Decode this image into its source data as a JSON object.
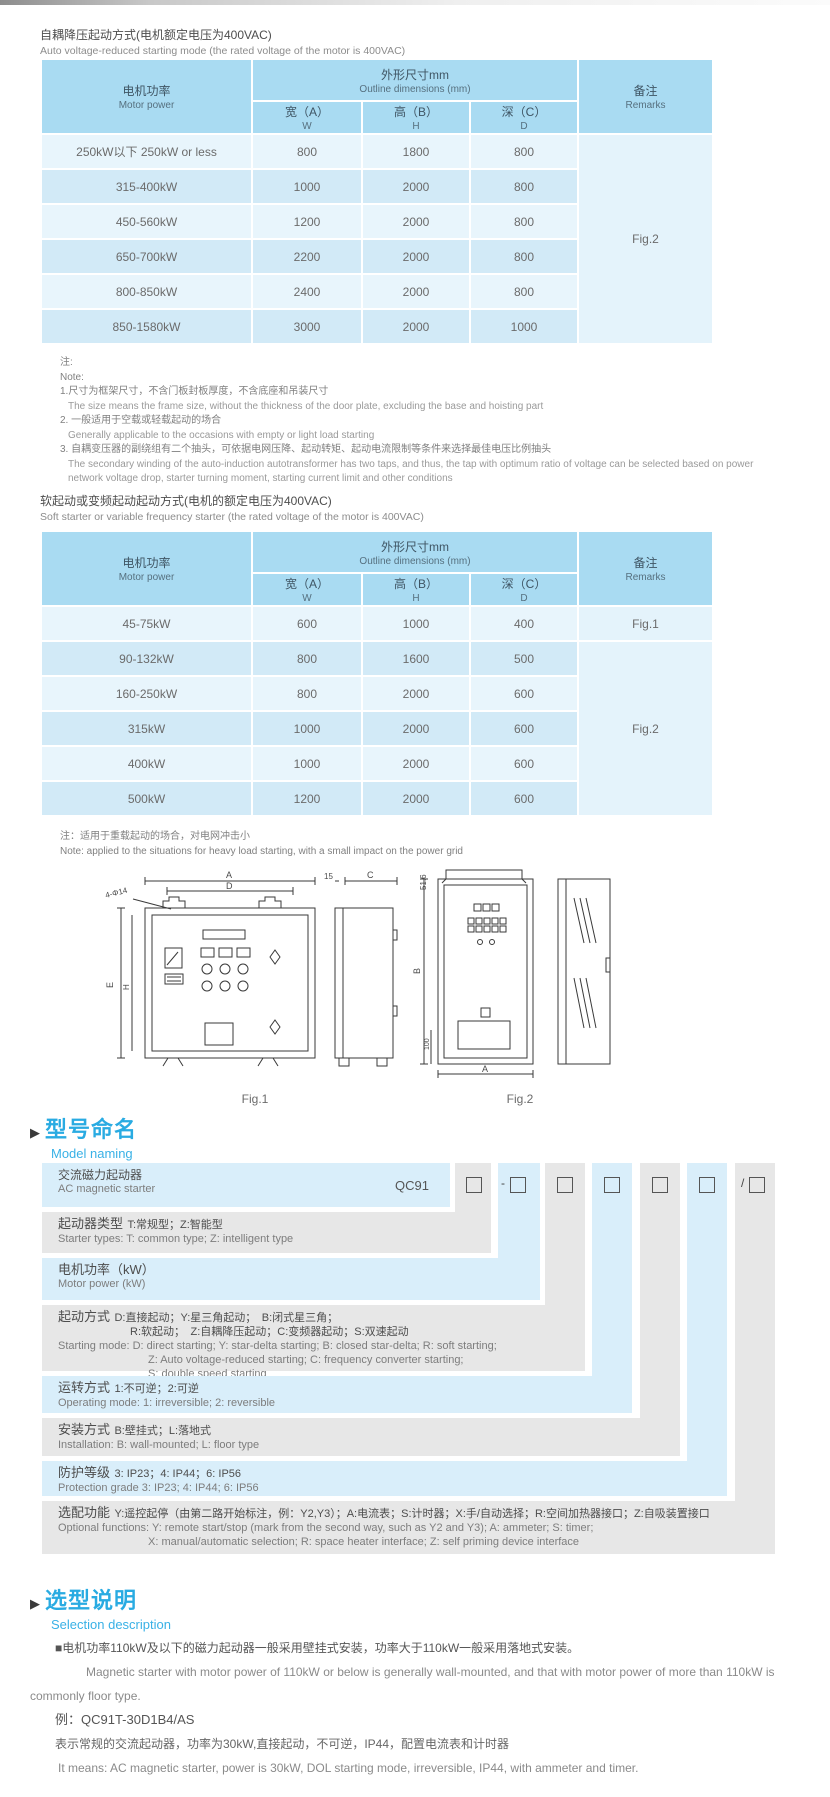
{
  "section1": {
    "title_cn": "自耦降压起动方式(电机额定电压为400VAC)",
    "title_en": "Auto voltage-reduced starting mode (the rated voltage of the motor is 400VAC)"
  },
  "dim_table_headers": {
    "motor_cn": "电机功率",
    "motor_en": "Motor power",
    "outline_cn": "外形尺寸mm",
    "outline_en": "Outline dimensions (mm)",
    "w_cn": "宽（A）",
    "w_en": "W",
    "h_cn": "高（B）",
    "h_en": "H",
    "d_cn": "深（C）",
    "d_en": "D",
    "remarks_cn": "备注",
    "remarks_en": "Remarks"
  },
  "table1": {
    "rows": [
      {
        "power": "250kW以下 250kW or less",
        "w": "800",
        "h": "1800",
        "d": "800"
      },
      {
        "power": "315-400kW",
        "w": "1000",
        "h": "2000",
        "d": "800"
      },
      {
        "power": "450-560kW",
        "w": "1200",
        "h": "2000",
        "d": "800"
      },
      {
        "power": "650-700kW",
        "w": "2200",
        "h": "2000",
        "d": "800"
      },
      {
        "power": "800-850kW",
        "w": "2400",
        "h": "2000",
        "d": "800"
      },
      {
        "power": "850-1580kW",
        "w": "3000",
        "h": "2000",
        "d": "1000"
      }
    ],
    "remark": "Fig.2"
  },
  "note1": {
    "cn_label": "注:",
    "en_label": "Note:",
    "item1_cn": "1.尺寸为框架尺寸，不含门板封板厚度，不含底座和吊装尺寸",
    "item1_en": "The size means the frame size, without the thickness of the door plate, excluding the base and hoisting part",
    "item2_cn": "2. 一般适用于空载或轻载起动的场合",
    "item2_en": "Generally applicable to the occasions with empty or light load starting",
    "item3_cn": "3. 自耦变压器的副绕组有二个抽头，可依据电网压降、起动转矩、起动电流限制等条件来选择最佳电压比例抽头",
    "item3_en": "The secondary winding of the auto-induction autotransformer has two taps, and thus, the tap with optimum ratio of voltage can be selected based on power network voltage drop, starter turning moment, starting current limit and other conditions"
  },
  "section2": {
    "title_cn": "软起动或变频起动起动方式(电机的额定电压为400VAC)",
    "title_en": "Soft starter or variable frequency starter (the rated voltage of the motor is 400VAC)"
  },
  "table2": {
    "rows": [
      {
        "power": "45-75kW",
        "w": "600",
        "h": "1000",
        "d": "400"
      },
      {
        "power": "90-132kW",
        "w": "800",
        "h": "1600",
        "d": "500"
      },
      {
        "power": "160-250kW",
        "w": "800",
        "h": "2000",
        "d": "600"
      },
      {
        "power": "315kW",
        "w": "1000",
        "h": "2000",
        "d": "600"
      },
      {
        "power": "400kW",
        "w": "1000",
        "h": "2000",
        "d": "600"
      },
      {
        "power": "500kW",
        "w": "1200",
        "h": "2000",
        "d": "600"
      }
    ],
    "remark_row1": "Fig.1",
    "remark_rest": "Fig.2"
  },
  "note2": {
    "cn": "注：适用于重载起动的场合，对电网冲击小",
    "en": "Note: applied to the situations for heavy load starting, with a small impact on the power grid"
  },
  "figures": {
    "fig1": {
      "caption": "Fig.1",
      "label_a": "A",
      "label_d": "D",
      "label_holes": "4-Φ14",
      "label_e": "E",
      "label_h": "H",
      "label_15": "15",
      "label_c": "C"
    },
    "fig2": {
      "caption": "Fig.2",
      "label_b": "B",
      "label_a": "A",
      "label_516": "51.6",
      "label_100": "100"
    }
  },
  "model_naming": {
    "heading_cn": "型号命名",
    "heading_en": "Model naming",
    "base_code": "QC91",
    "dash": "-",
    "slash": "/",
    "row1": {
      "cn": "交流磁力起动器",
      "en": "AC magnetic starter"
    },
    "row2": {
      "label": "起动器类型",
      "desc": "T:常规型；Z:智能型",
      "en": "Starter types: T: common type; Z: intelligent type"
    },
    "row3": {
      "label": "电机功率（kW）",
      "en": "Motor power (kW)"
    },
    "row4": {
      "label": "起动方式",
      "desc1": "D:直接起动；Y:星三角起动；　B:闭式星三角；",
      "desc2": "R:软起动；　Z:自耦降压起动；C:变频器起动；S:双速起动",
      "en1": "Starting mode: D: direct starting; Y: star-delta starting; B: closed star-delta; R: soft starting;",
      "en2": "Z: Auto voltage-reduced starting; C: frequency converter starting;",
      "en3": "S: double speed starting"
    },
    "row5": {
      "label": "运转方式",
      "desc": "1:不可逆；2:可逆",
      "en": "Operating mode: 1: irreversible; 2: reversible"
    },
    "row6": {
      "label": "安装方式",
      "desc": "B:壁挂式；L:落地式",
      "en": "Installation: B: wall-mounted; L: floor type"
    },
    "row7": {
      "label": "防护等级",
      "desc": "3: IP23；4: IP44；6: IP56",
      "en": "Protection grade  3: IP23; 4: IP44; 6: IP56"
    },
    "row8": {
      "label": "选配功能",
      "desc": "Y:遥控起停（由第二路开始标注，例：Y2,Y3）；A:电流表；S:计时器；X:手/自动选择；R:空间加热器接口；Z:自吸装置接口",
      "en1": "Optional functions: Y: remote start/stop (mark from the second way, such as Y2 and Y3); A: ammeter; S: timer;",
      "en2": "X: manual/automatic selection; R: space heater interface; Z: self priming device interface"
    }
  },
  "selection": {
    "heading_cn": "选型说明",
    "heading_en": "Selection description",
    "p1_cn": "■电机功率110kW及以下的磁力起动器一般采用壁挂式安装，功率大于110kW一般采用落地式安装。",
    "p1_en": "Magnetic starter with motor power of 110kW or below is generally wall-mounted, and that with motor power of more than 110kW is commonly floor type.",
    "example_label": "例：QC91T-30D1B4/AS",
    "example_cn": "表示常规的交流起动器，功率为30kW,直接起动，不可逆，IP44，配置电流表和计时器",
    "example_en": "It means: AC magnetic starter, power is 30kW, DOL starting mode, irreversible, IP44, with ammeter and timer."
  }
}
